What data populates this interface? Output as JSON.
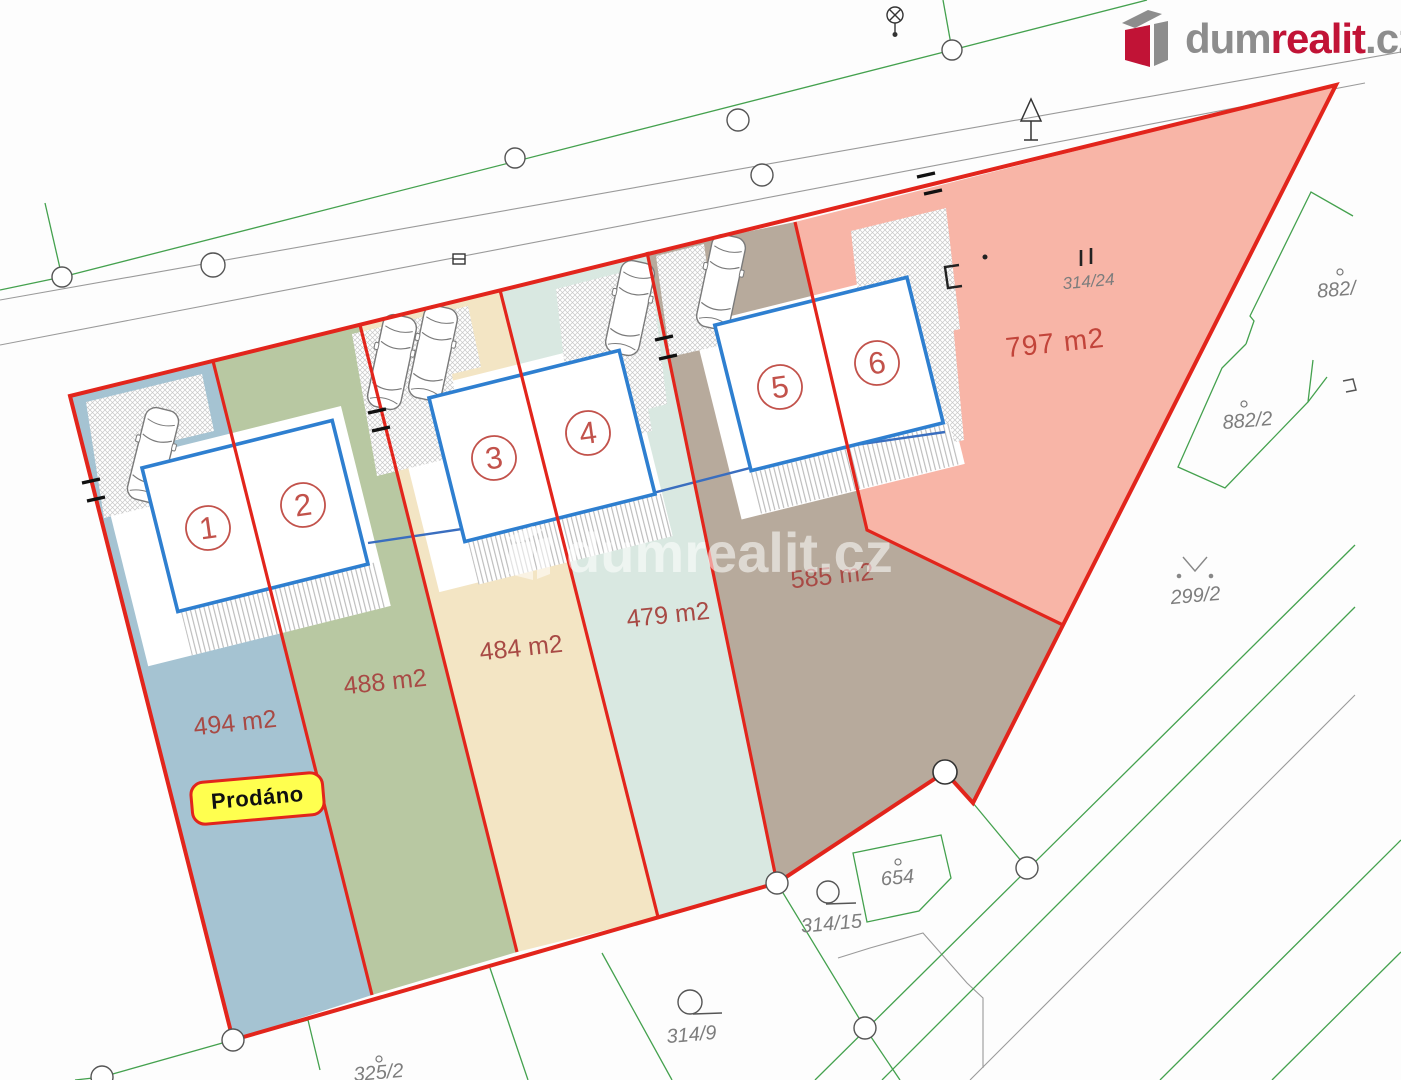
{
  "brand": {
    "logo": {
      "dum": "dum",
      "realit": "realit",
      "cz": ".cz",
      "color_gray": "#8d8d8d",
      "color_red": "#c11336"
    },
    "watermark_text": "dumrealit.cz"
  },
  "site_plan": {
    "sold_badge": "Prodáno",
    "boundary_color": "#e2251c",
    "house_outline_color": "#2e7fd0",
    "cadastral_line_color": "#44a14e",
    "road_line_color": "#9a9a9a",
    "plots": [
      {
        "number": "1",
        "area_label": "494 m2",
        "fill": "#a5c3d2",
        "sold": true
      },
      {
        "number": "2",
        "area_label": "488 m2",
        "fill": "#b8c8a2",
        "sold": false
      },
      {
        "number": "3",
        "area_label": "484 m2",
        "fill": "#f3e5c4",
        "sold": false
      },
      {
        "number": "4",
        "area_label": "479 m2",
        "fill": "#d9e8e1",
        "sold": false
      },
      {
        "number": "5",
        "area_label": "585 m2",
        "fill": "#b7aa9c",
        "sold": false
      },
      {
        "number": "6",
        "area_label": "797 m2",
        "fill": "#f8b5a7",
        "sold": false
      }
    ],
    "parcels": [
      {
        "id": "314/24"
      },
      {
        "id": "882/"
      },
      {
        "id": "882/2"
      },
      {
        "id": "299/2"
      },
      {
        "id": "654"
      },
      {
        "id": "314/15"
      },
      {
        "id": "314/9"
      },
      {
        "id": "325/2"
      }
    ]
  }
}
